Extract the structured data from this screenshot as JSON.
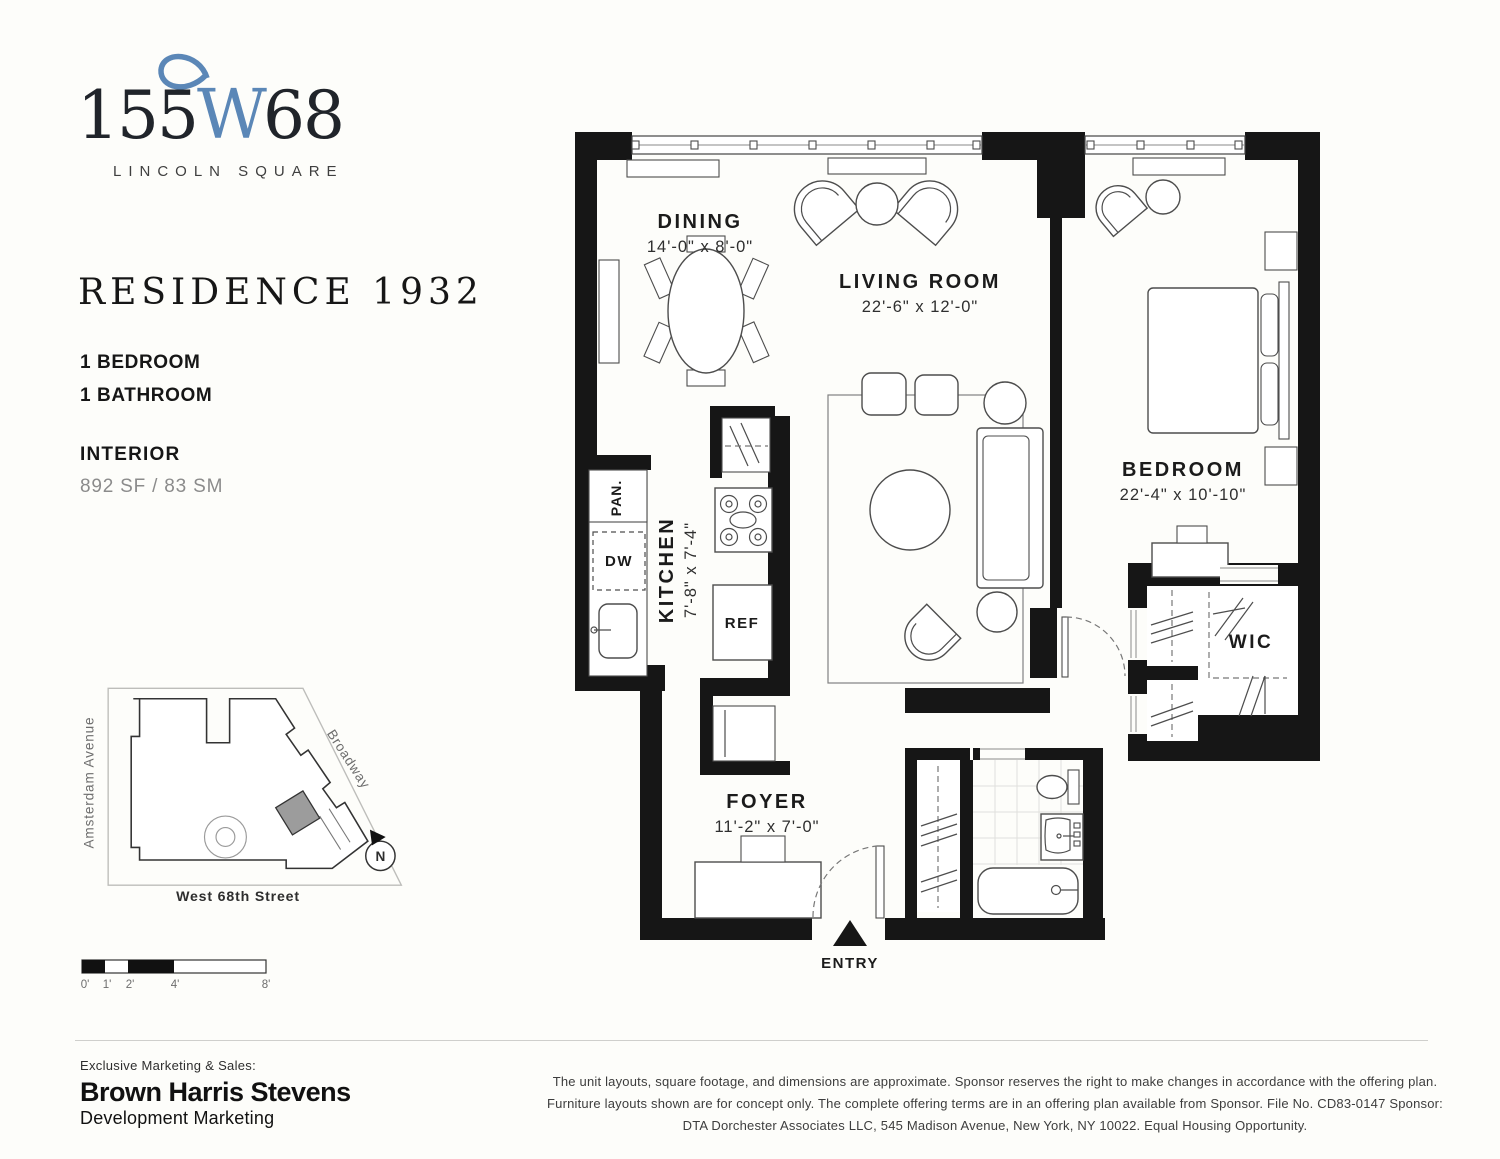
{
  "logo": {
    "prefix": "155",
    "w": "W",
    "suffix": "68",
    "subtitle": "LINCOLN SQUARE"
  },
  "unit": {
    "title": "RESIDENCE 1932",
    "bedrooms": "1 BEDROOM",
    "bathrooms": "1 BATHROOM",
    "interior_label": "INTERIOR",
    "area": "892 SF / 83 SM"
  },
  "site_map": {
    "street_left": "Amsterdam Avenue",
    "street_right": "Broadway",
    "street_bottom": "West 68th Street",
    "compass": "N"
  },
  "scale_bar": {
    "labels": [
      "0'",
      "1'",
      "2'",
      "4'",
      "8'"
    ]
  },
  "floor_plan": {
    "rooms": [
      {
        "name": "DINING",
        "dims": "14'-0\" x 8'-0\""
      },
      {
        "name": "LIVING ROOM",
        "dims": "22'-6\" x 12'-0\""
      },
      {
        "name": "BEDROOM",
        "dims": "22'-4\" x 10'-10\""
      },
      {
        "name": "KITCHEN",
        "dims": "7'-8\" x 7'-4\""
      },
      {
        "name": "FOYER",
        "dims": "11'-2\" x 7'-0\""
      }
    ],
    "labels": {
      "wic": "WIC",
      "pantry": "PAN.",
      "dishwasher": "DW",
      "refrigerator": "REF",
      "entry": "ENTRY"
    }
  },
  "footer": {
    "kicker": "Exclusive Marketing & Sales:",
    "brand": "Brown Harris Stevens",
    "brand_sub": "Development Marketing",
    "disclaimer": "The unit layouts, square footage, and dimensions are approximate. Sponsor reserves the right to make changes in accordance with the offering plan. Furniture layouts shown are for concept only. The complete offering terms are in an offering plan available from Sponsor. File No. CD83-0147 Sponsor: DTA Dorchester Associates LLC, 545 Madison Avenue, New York, NY 10022. Equal Housing Opportunity."
  },
  "colors": {
    "accent_blue": "#5b87b7",
    "wall_black": "#161616"
  }
}
